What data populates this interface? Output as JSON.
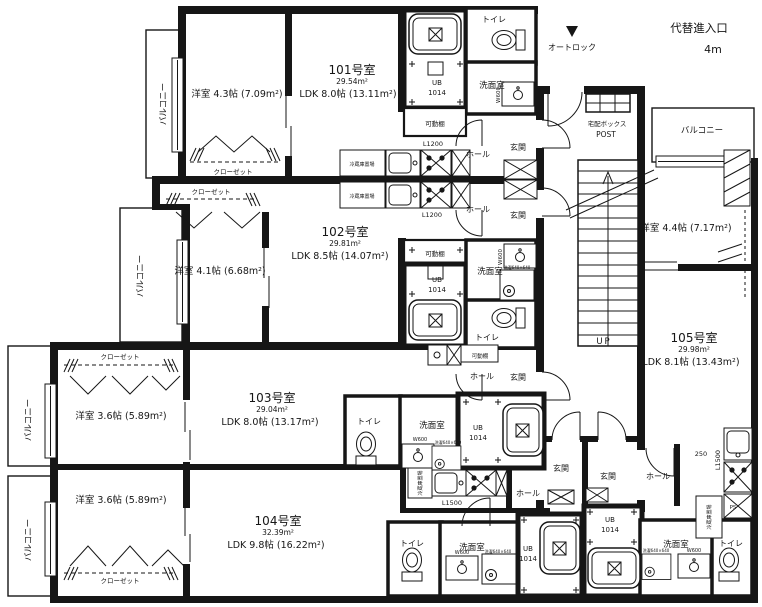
{
  "site": {
    "alt_entry": "代替進入口",
    "alt_entry_size": "4m",
    "autolock": "オートロック",
    "delivery_box": "宅配ボックス",
    "post": "POST",
    "up": "UP",
    "dim_250": "250",
    "ps": "PS"
  },
  "glossary": {
    "genkan": "玄関",
    "hall": "ホール",
    "toilet": "トイレ",
    "washroom": "洗面室",
    "closet": "クローゼット",
    "balcony": "バルコニー",
    "shelf": "可動棚",
    "fridge": "冷蔵庫置場",
    "ub1": "UB",
    "ub2": "1014",
    "w600": "W600",
    "l1200": "L1200",
    "l1500": "L1500",
    "washer": "洗濯640×640"
  },
  "units": [
    {
      "id": "101",
      "name": "101号室",
      "area": "29.54m²",
      "ldk": "LDK 8.0帖 (13.11m²)",
      "bedroom": "洋室 4.3帖 (7.09m²)"
    },
    {
      "id": "102",
      "name": "102号室",
      "area": "29.81m²",
      "ldk": "LDK 8.5帖 (14.07m²)",
      "bedroom": "洋室 4.1帖 (6.68m²)"
    },
    {
      "id": "103",
      "name": "103号室",
      "area": "29.04m²",
      "ldk": "LDK 8.0帖 (13.17m²)",
      "bedroom": "洋室 3.6帖 (5.89m²)"
    },
    {
      "id": "104",
      "name": "104号室",
      "area": "32.39m²",
      "ldk": "LDK 9.8帖 (16.22m²)",
      "bedroom": "洋室 3.6帖 (5.89m²)"
    },
    {
      "id": "105",
      "name": "105号室",
      "area": "29.98m²",
      "ldk": "LDK 8.1帖 (13.43m²)",
      "bedroom": "洋室 4.4帖 (7.17m²)"
    }
  ]
}
